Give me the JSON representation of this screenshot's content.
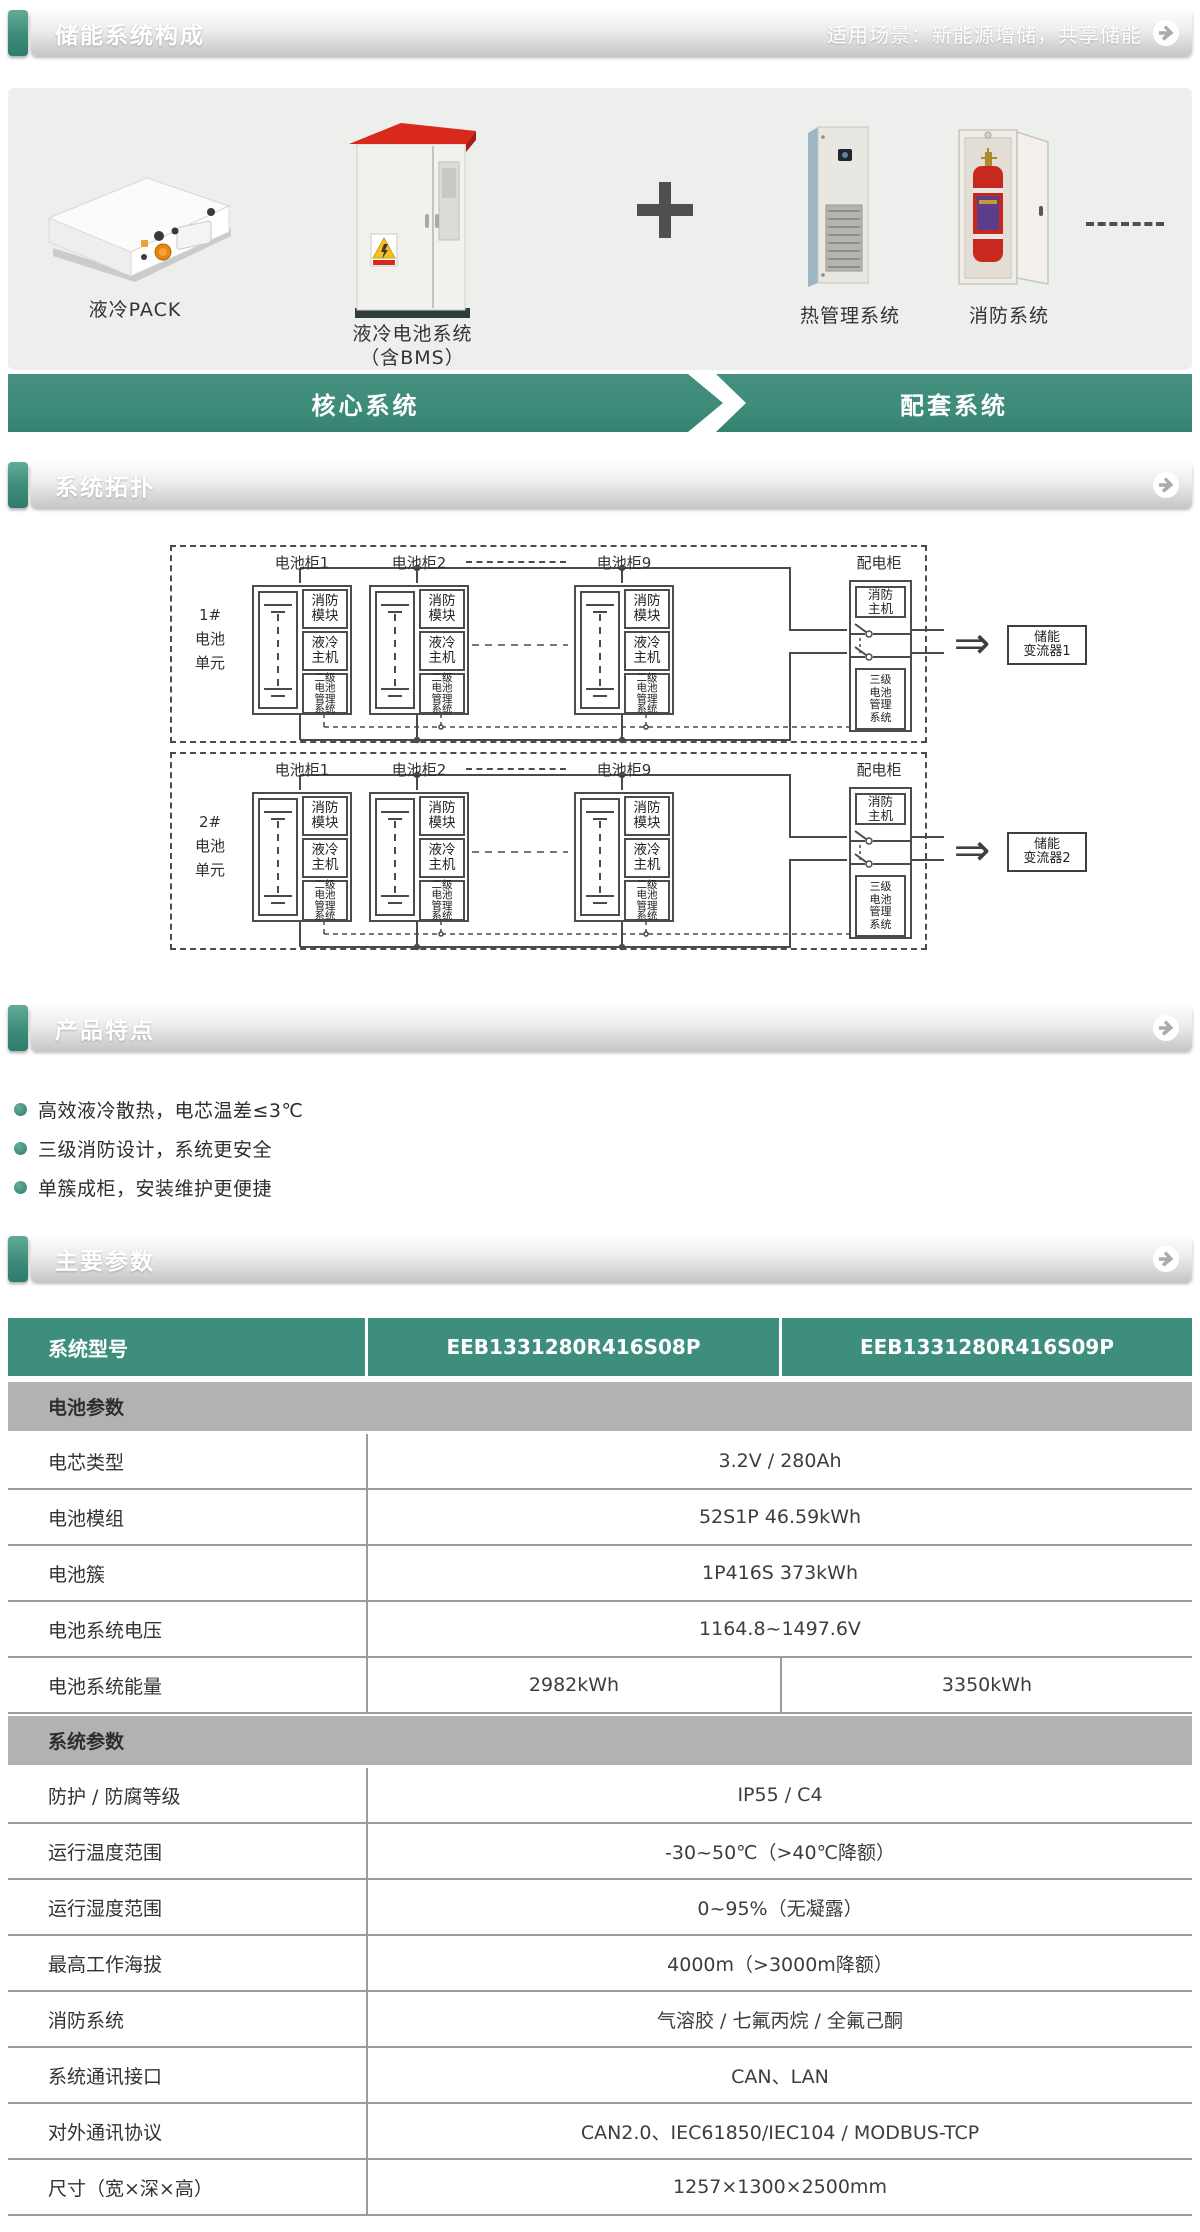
{
  "colors": {
    "teal": "#3E8E7D",
    "band_bg": "#EDEFED",
    "section_gray": "#B2B2B2",
    "line": "#4C4C4C"
  },
  "composition": {
    "title": "储能系统构成",
    "scenario": "适用场景：新能源增储，共享储能",
    "products": [
      {
        "name": "液冷PACK"
      },
      {
        "name": "液冷电池系统",
        "sub": "（含BMS）"
      },
      {
        "name": "热管理系统"
      },
      {
        "name": "消防系统"
      }
    ],
    "banner": {
      "core": "核心系统",
      "support": "配套系统"
    }
  },
  "topology": {
    "title": "系统拓扑",
    "cabinet_labels": [
      "电池柜1",
      "电池柜2",
      "电池柜9"
    ],
    "module_labels": [
      [
        "消防",
        "模块"
      ],
      [
        "液冷",
        "主机"
      ],
      [
        "二级",
        "电池",
        "管理",
        "系统"
      ]
    ],
    "dist_label": "配电柜",
    "dist_fire": [
      "消防",
      "主机"
    ],
    "dist_bms": [
      "三级",
      "电池",
      "管理",
      "系统"
    ],
    "arrow_glyph": "⇒",
    "units": [
      {
        "label_lines": [
          "1#",
          "电池",
          "单元"
        ],
        "pcs_lines": [
          "储能",
          "变流器1"
        ]
      },
      {
        "label_lines": [
          "2#",
          "电池",
          "单元"
        ],
        "pcs_lines": [
          "储能",
          "变流器2"
        ]
      }
    ]
  },
  "features": {
    "title": "产品特点",
    "items": [
      "高效液冷散热，电芯温差≤3℃",
      "三级消防设计，系统更安全",
      "单簇成柜，安装维护更便捷"
    ]
  },
  "parameters": {
    "title": "主要参数",
    "table": {
      "header": {
        "label": "系统型号",
        "models": [
          "EEB1331280R416S08P",
          "EEB1331280R416S09P"
        ]
      },
      "rows": [
        {
          "type": "section",
          "label": "电池参数"
        },
        {
          "type": "row",
          "label": "电芯类型",
          "value": "3.2V / 280Ah"
        },
        {
          "type": "row",
          "label": "电池模组",
          "value": "52S1P 46.59kWh"
        },
        {
          "type": "row",
          "label": "电池簇",
          "value": "1P416S 373kWh"
        },
        {
          "type": "row",
          "label": "电池系统电压",
          "value": "1164.8~1497.6V"
        },
        {
          "type": "row",
          "label": "电池系统能量",
          "values": [
            "2982kWh",
            "3350kWh"
          ]
        },
        {
          "type": "section",
          "label": "系统参数"
        },
        {
          "type": "row",
          "label": "防护 / 防腐等级",
          "value": "IP55 / C4"
        },
        {
          "type": "row",
          "label": "运行温度范围",
          "value": "-30~50℃（>40℃降额）"
        },
        {
          "type": "row",
          "label": "运行湿度范围",
          "value": "0~95%（无凝露）"
        },
        {
          "type": "row",
          "label": "最高工作海拔",
          "value": "4000m（>3000m降额）"
        },
        {
          "type": "row",
          "label": "消防系统",
          "value": "气溶胶 / 七氟丙烷 / 全氟己酮"
        },
        {
          "type": "row",
          "label": "系统通讯接口",
          "value": "CAN、LAN"
        },
        {
          "type": "row",
          "label": "对外通讯协议",
          "value": "CAN2.0、IEC61850/IEC104 / MODBUS-TCP"
        },
        {
          "type": "row",
          "label": "尺寸（宽×深×高）",
          "value": "1257×1300×2500mm"
        }
      ]
    }
  }
}
